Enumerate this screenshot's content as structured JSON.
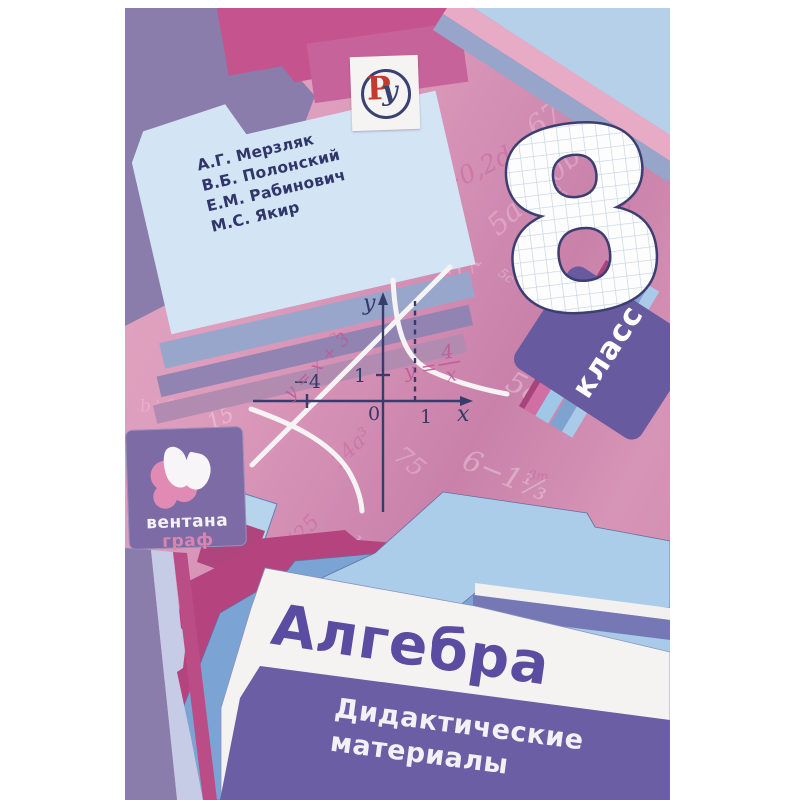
{
  "cover": {
    "authors": [
      "А.Г. Мерзляк",
      "В.Б. Полонский",
      "Е.М. Рабинович",
      "М.С. Якир"
    ],
    "grade_number": "8",
    "grade_label": "класс",
    "title": "Алгебра",
    "subtitle_lines": [
      "Дидактические",
      "материалы"
    ],
    "publisher": {
      "line1": "вентана",
      "line2": "граф"
    },
    "badge": {
      "letter_p": "Р",
      "letter_u": "у"
    },
    "graph": {
      "y_axis": "у",
      "x_axis": "х",
      "origin": "0",
      "y_tick_1": "1",
      "x_tick_1": "1",
      "x_tick_minus4": "−4",
      "line_label": "y = x + 3",
      "hyperbola_lhs": "y =",
      "hyperbola_numerator": "4",
      "hyperbola_denominator": "x"
    },
    "formulas": [
      "3a²−2b",
      "√(x+2)",
      "14a³",
      "21a⁴",
      "67·90",
      "10b²",
      "(a−b)²",
      "3m=−34",
      "2c−0,2d",
      "5a⁴",
      "20²",
      "9ab",
      "m+7m",
      "75",
      "172:6",
      "x−2",
      "5m",
      "√25",
      "2m−3n",
      "5a+20b",
      "3a",
      "10a²",
      "58/5",
      "239",
      "6−1⅓",
      "10",
      "7a²b",
      "a",
      "k",
      "3у",
      "√22",
      "b+a",
      "25b",
      "100b²",
      "12x",
      "8m",
      "−2",
      "(a+b)²",
      "x³",
      "36",
      "√81",
      "4b",
      "15",
      "a²",
      "−9",
      "5c"
    ],
    "colors": {
      "background_pink": "#dd9cbc",
      "magenta_band": "#c5538e",
      "muted_purple": "#8a7cab",
      "authors_folder_blue": "#d3e5f5",
      "klass_tab_purple": "#675a9e",
      "bottom_panel_purple": "#6b5ea4",
      "title_purple": "#5a4ca0",
      "white_folder": "#f5f3f1",
      "light_blue_folder": "#abcdea",
      "mid_blue_folder": "#7ba4d4",
      "magenta_folder": "#b5437e",
      "badge_red": "#c23b2e",
      "badge_blue": "#3a4274",
      "graph_axis": "#383c6a",
      "curve_white": "#f6f3f5"
    }
  }
}
